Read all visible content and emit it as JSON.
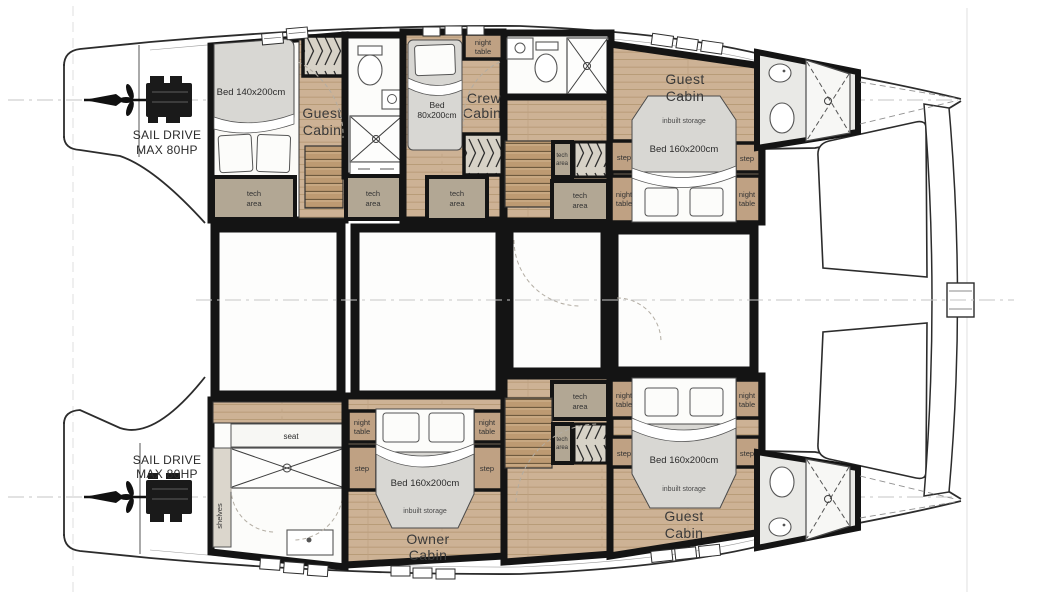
{
  "title": "Catamaran lower deck floor plan",
  "colors": {
    "wall": "#141414",
    "wood": "#cdb295",
    "stairs": "#bd9a72",
    "tech_area": "#b2a794",
    "furniture_block": "#bfa183",
    "bed_mattress": "#d8d7d3",
    "bathroom_floor": "#e9e9e6",
    "outline": "#2c2c2c"
  },
  "engines": {
    "port": {
      "line1": "SAIL DRIVE",
      "line2": "MAX 80HP"
    },
    "starboard": {
      "line1": "SAIL DRIVE",
      "line2": "MAX 80HP"
    }
  },
  "cabins": {
    "aft_guest": {
      "name1": "Guest",
      "name2": "Cabin",
      "bed": "Bed 140x200cm"
    },
    "crew": {
      "name1": "Crew",
      "name2": "Cabin",
      "bed1": "Bed",
      "bed2": "80x200cm"
    },
    "fwd_guest_port": {
      "name1": "Guest",
      "name2": "Cabin",
      "bed": "Bed 160x200cm",
      "storage": "inbuilt storage"
    },
    "owner": {
      "name1": "Owner",
      "name2": "Cabin",
      "bed": "Bed 160x200cm",
      "storage": "inbuilt storage"
    },
    "fwd_guest_starboard": {
      "name1": "Guest",
      "name2": "Cabin",
      "bed": "Bed 160x200cm",
      "storage": "inbuilt storage"
    }
  },
  "labels": {
    "tech1": "tech",
    "tech2": "area",
    "night1": "night",
    "night2": "table",
    "step": "step",
    "seat": "seat",
    "shelves": "shelves"
  }
}
